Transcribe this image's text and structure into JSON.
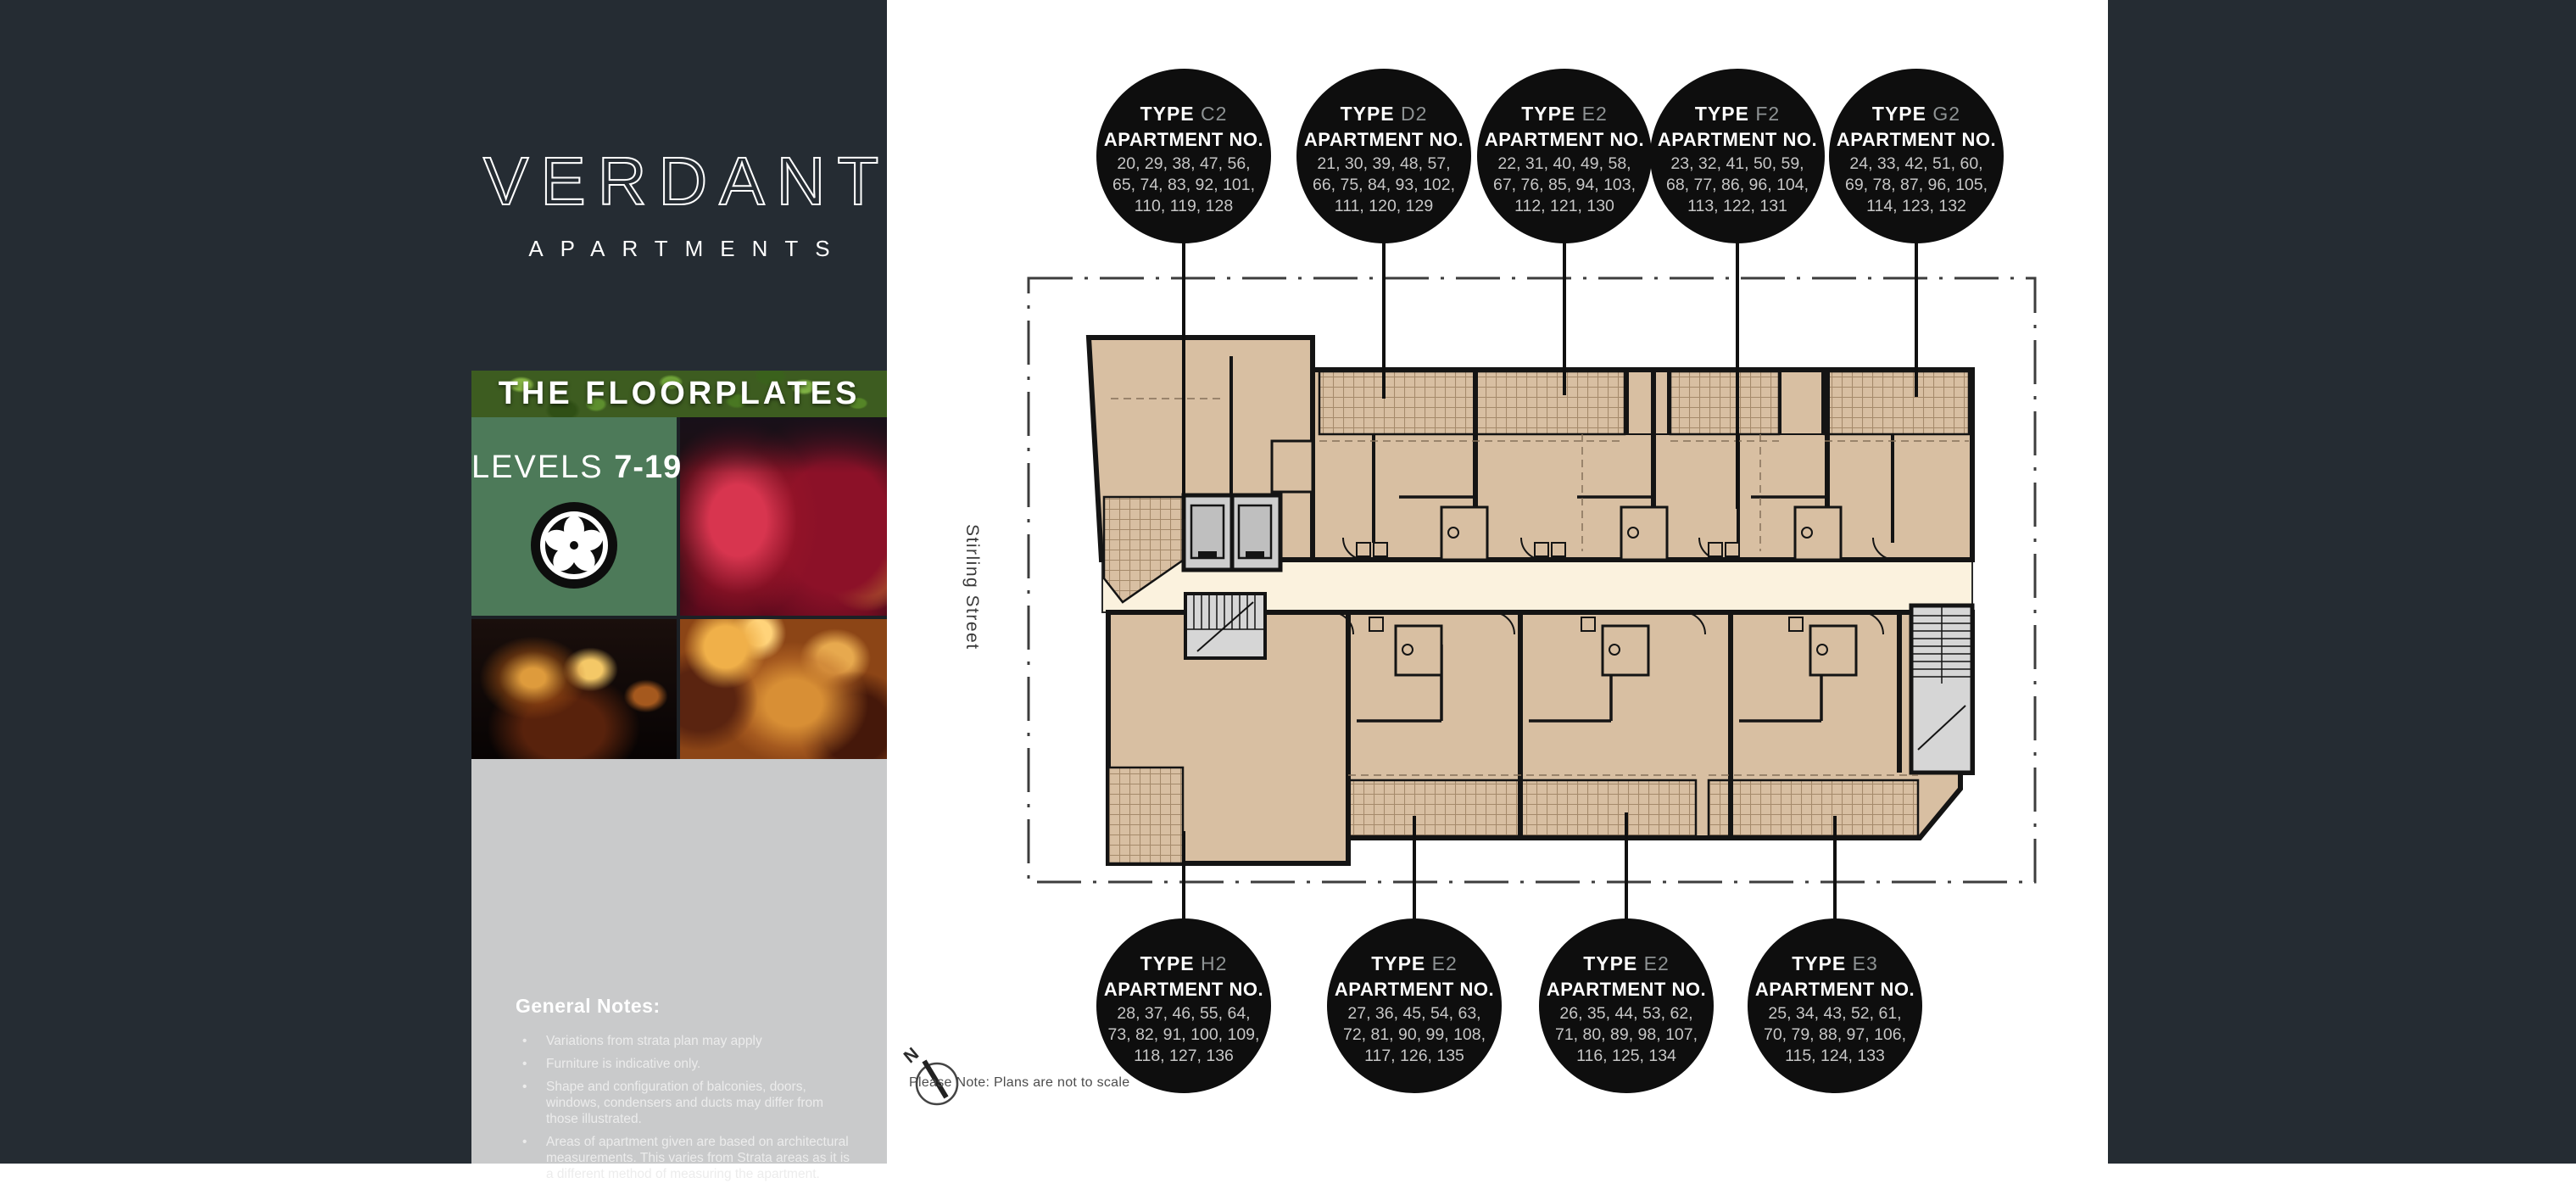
{
  "brand": {
    "name": "VERDANT",
    "tagline": "APARTMENTS"
  },
  "sidebar": {
    "section_title": "THE FLOORPLATES",
    "levels_label": "LEVELS",
    "levels_range": "7-19",
    "general_notes": {
      "title": "General Notes:",
      "items": [
        "Variations from strata plan may apply",
        "Furniture is indicative only.",
        "Shape and configuration of balconies, doors, windows, condensers and ducts may differ from those illustrated.",
        "Areas of apartment given are based on architectural measurements. This varies from Strata areas as it is a different method of measuring the apartment."
      ]
    }
  },
  "plan": {
    "street_label": "Stirling Street",
    "note": "Please Note: Plans are not to scale",
    "compass_label": "N"
  },
  "callouts": {
    "top": [
      {
        "type_label": "TYPE",
        "code": "C2",
        "apt_label": "APARTMENT NO.",
        "lines": [
          "20, 29, 38, 47, 56,",
          "65, 74, 83, 92, 101,",
          "110, 119, 128"
        ]
      },
      {
        "type_label": "TYPE",
        "code": "D2",
        "apt_label": "APARTMENT NO.",
        "lines": [
          "21, 30, 39, 48, 57,",
          "66, 75, 84, 93, 102,",
          "111, 120, 129"
        ]
      },
      {
        "type_label": "TYPE",
        "code": "E2",
        "apt_label": "APARTMENT NO.",
        "lines": [
          "22, 31, 40, 49, 58,",
          "67, 76, 85, 94, 103,",
          "112, 121, 130"
        ]
      },
      {
        "type_label": "TYPE",
        "code": "F2",
        "apt_label": "APARTMENT NO.",
        "lines": [
          "23, 32, 41, 50, 59,",
          "68, 77, 86, 96, 104,",
          "113, 122, 131"
        ]
      },
      {
        "type_label": "TYPE",
        "code": "G2",
        "apt_label": "APARTMENT NO.",
        "lines": [
          "24, 33, 42, 51, 60,",
          "69, 78, 87, 96, 105,",
          "114, 123, 132"
        ]
      }
    ],
    "bottom": [
      {
        "type_label": "TYPE",
        "code": "H2",
        "apt_label": "APARTMENT NO.",
        "lines": [
          "28, 37, 46, 55, 64,",
          "73, 82, 91, 100, 109,",
          "118, 127, 136"
        ]
      },
      {
        "type_label": "TYPE",
        "code": "E2",
        "apt_label": "APARTMENT NO.",
        "lines": [
          "27, 36, 45, 54, 63,",
          "72, 81, 90, 99, 108,",
          "117, 126, 135"
        ]
      },
      {
        "type_label": "TYPE",
        "code": "E2",
        "apt_label": "APARTMENT NO.",
        "lines": [
          "26, 35, 44, 53, 62,",
          "71, 80, 89, 98, 107,",
          "116, 125, 134"
        ]
      },
      {
        "type_label": "TYPE",
        "code": "E3",
        "apt_label": "APARTMENT NO.",
        "lines": [
          "25, 34, 43, 52, 61,",
          "70, 79, 88, 97, 106,",
          "115, 124, 133"
        ]
      }
    ]
  },
  "colors": {
    "charcoal": "#252c33",
    "green_panel": "#4d7a59",
    "plan_beige": "#d8bfa2",
    "corridor_cream": "#fbf2de",
    "notes_gray": "#c9cacb",
    "callout_black": "#0e0e0e",
    "wall_black": "#141414"
  }
}
